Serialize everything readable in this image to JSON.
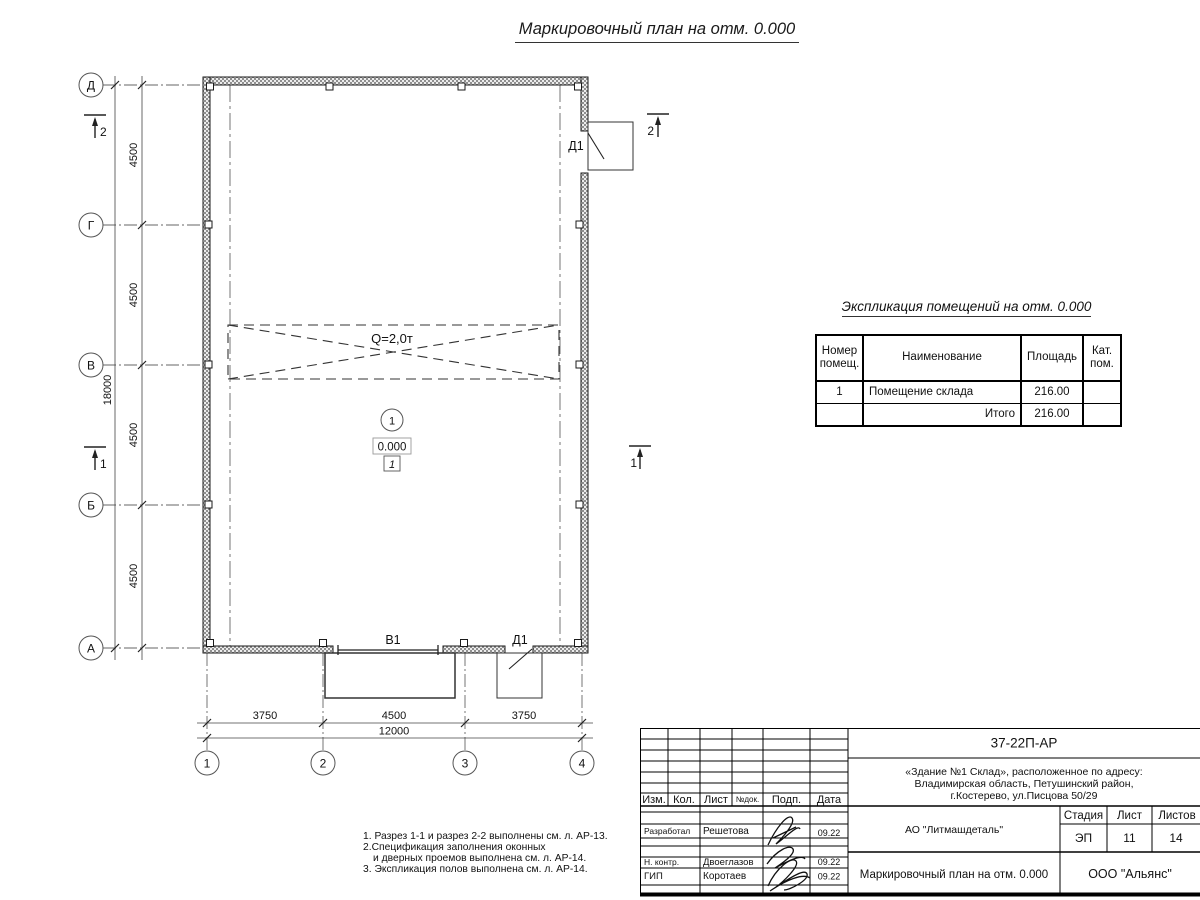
{
  "page": {
    "title": "Маркировочный план на отм. 0.000"
  },
  "plan": {
    "axis_rows": [
      "Д",
      "Г",
      "В",
      "Б",
      "А"
    ],
    "axis_cols": [
      "1",
      "2",
      "3",
      "4"
    ],
    "dims_left_segments": [
      "4500",
      "4500",
      "4500",
      "4500"
    ],
    "dim_left_total": "18000",
    "dims_bottom_segments": [
      "3750",
      "4500",
      "3750"
    ],
    "dim_bottom_total": "12000",
    "crane_label": "Q=2,0т",
    "room_number": "1",
    "elevation": "0.000",
    "floor_type": "1",
    "door_top": "Д1",
    "door_bottom": "Д1",
    "gate": "В1",
    "section_left_top": "2",
    "section_left_mid": "1",
    "section_right_top": "2",
    "section_right_mid": "1"
  },
  "explication": {
    "title": "Экспликация помещений на отм. 0.000",
    "col_headers": [
      "Номер помещ.",
      "Наименование",
      "Площадь",
      "Кат. пом."
    ],
    "row": {
      "num": "1",
      "name": "Помещение склада",
      "area": "216.00",
      "cat": ""
    },
    "total_label": "Итого",
    "total_area": "216.00"
  },
  "notes": {
    "n1": "1. Разрез 1-1 и разрез 2-2 выполнены см. л. АР-13.",
    "n2": "2.Спецификация заполнения оконных",
    "n2b": "и дверных проемов выполнена см. л. АР-14.",
    "n3": "3. Экспликация полов выполнена см. л. АР-14."
  },
  "titleblock": {
    "doc_code": "37-22П-АР",
    "address1": "«Здание №1 Склад», расположенное по адресу:",
    "address2": "Владимирская область, Петушинский район,",
    "address3": "г.Костерево, ул.Писцова 50/29",
    "h_izm": "Изм.",
    "h_kol": "Кол.",
    "h_list": "Лист",
    "h_ndok": "№док.",
    "h_podp": "Подп.",
    "h_data": "Дата",
    "r1_role": "Разработал",
    "r1_name": "Решетова",
    "r1_date": "09.22",
    "r2_role": "Н. контр.",
    "r2_name": "Двоеглазов",
    "r2_date": "09.22",
    "r3_role": "ГИП",
    "r3_name": "Коротаев",
    "r3_date": "09.22",
    "company": "АО \"Литмашдеталь\"",
    "stage_h": "Стадия",
    "sheet_h": "Лист",
    "sheets_h": "Листов",
    "stage": "ЭП",
    "sheet": "11",
    "sheets": "14",
    "drawing_name": "Маркировочный план на отм. 0.000",
    "org": "ООО \"Альянс\""
  }
}
